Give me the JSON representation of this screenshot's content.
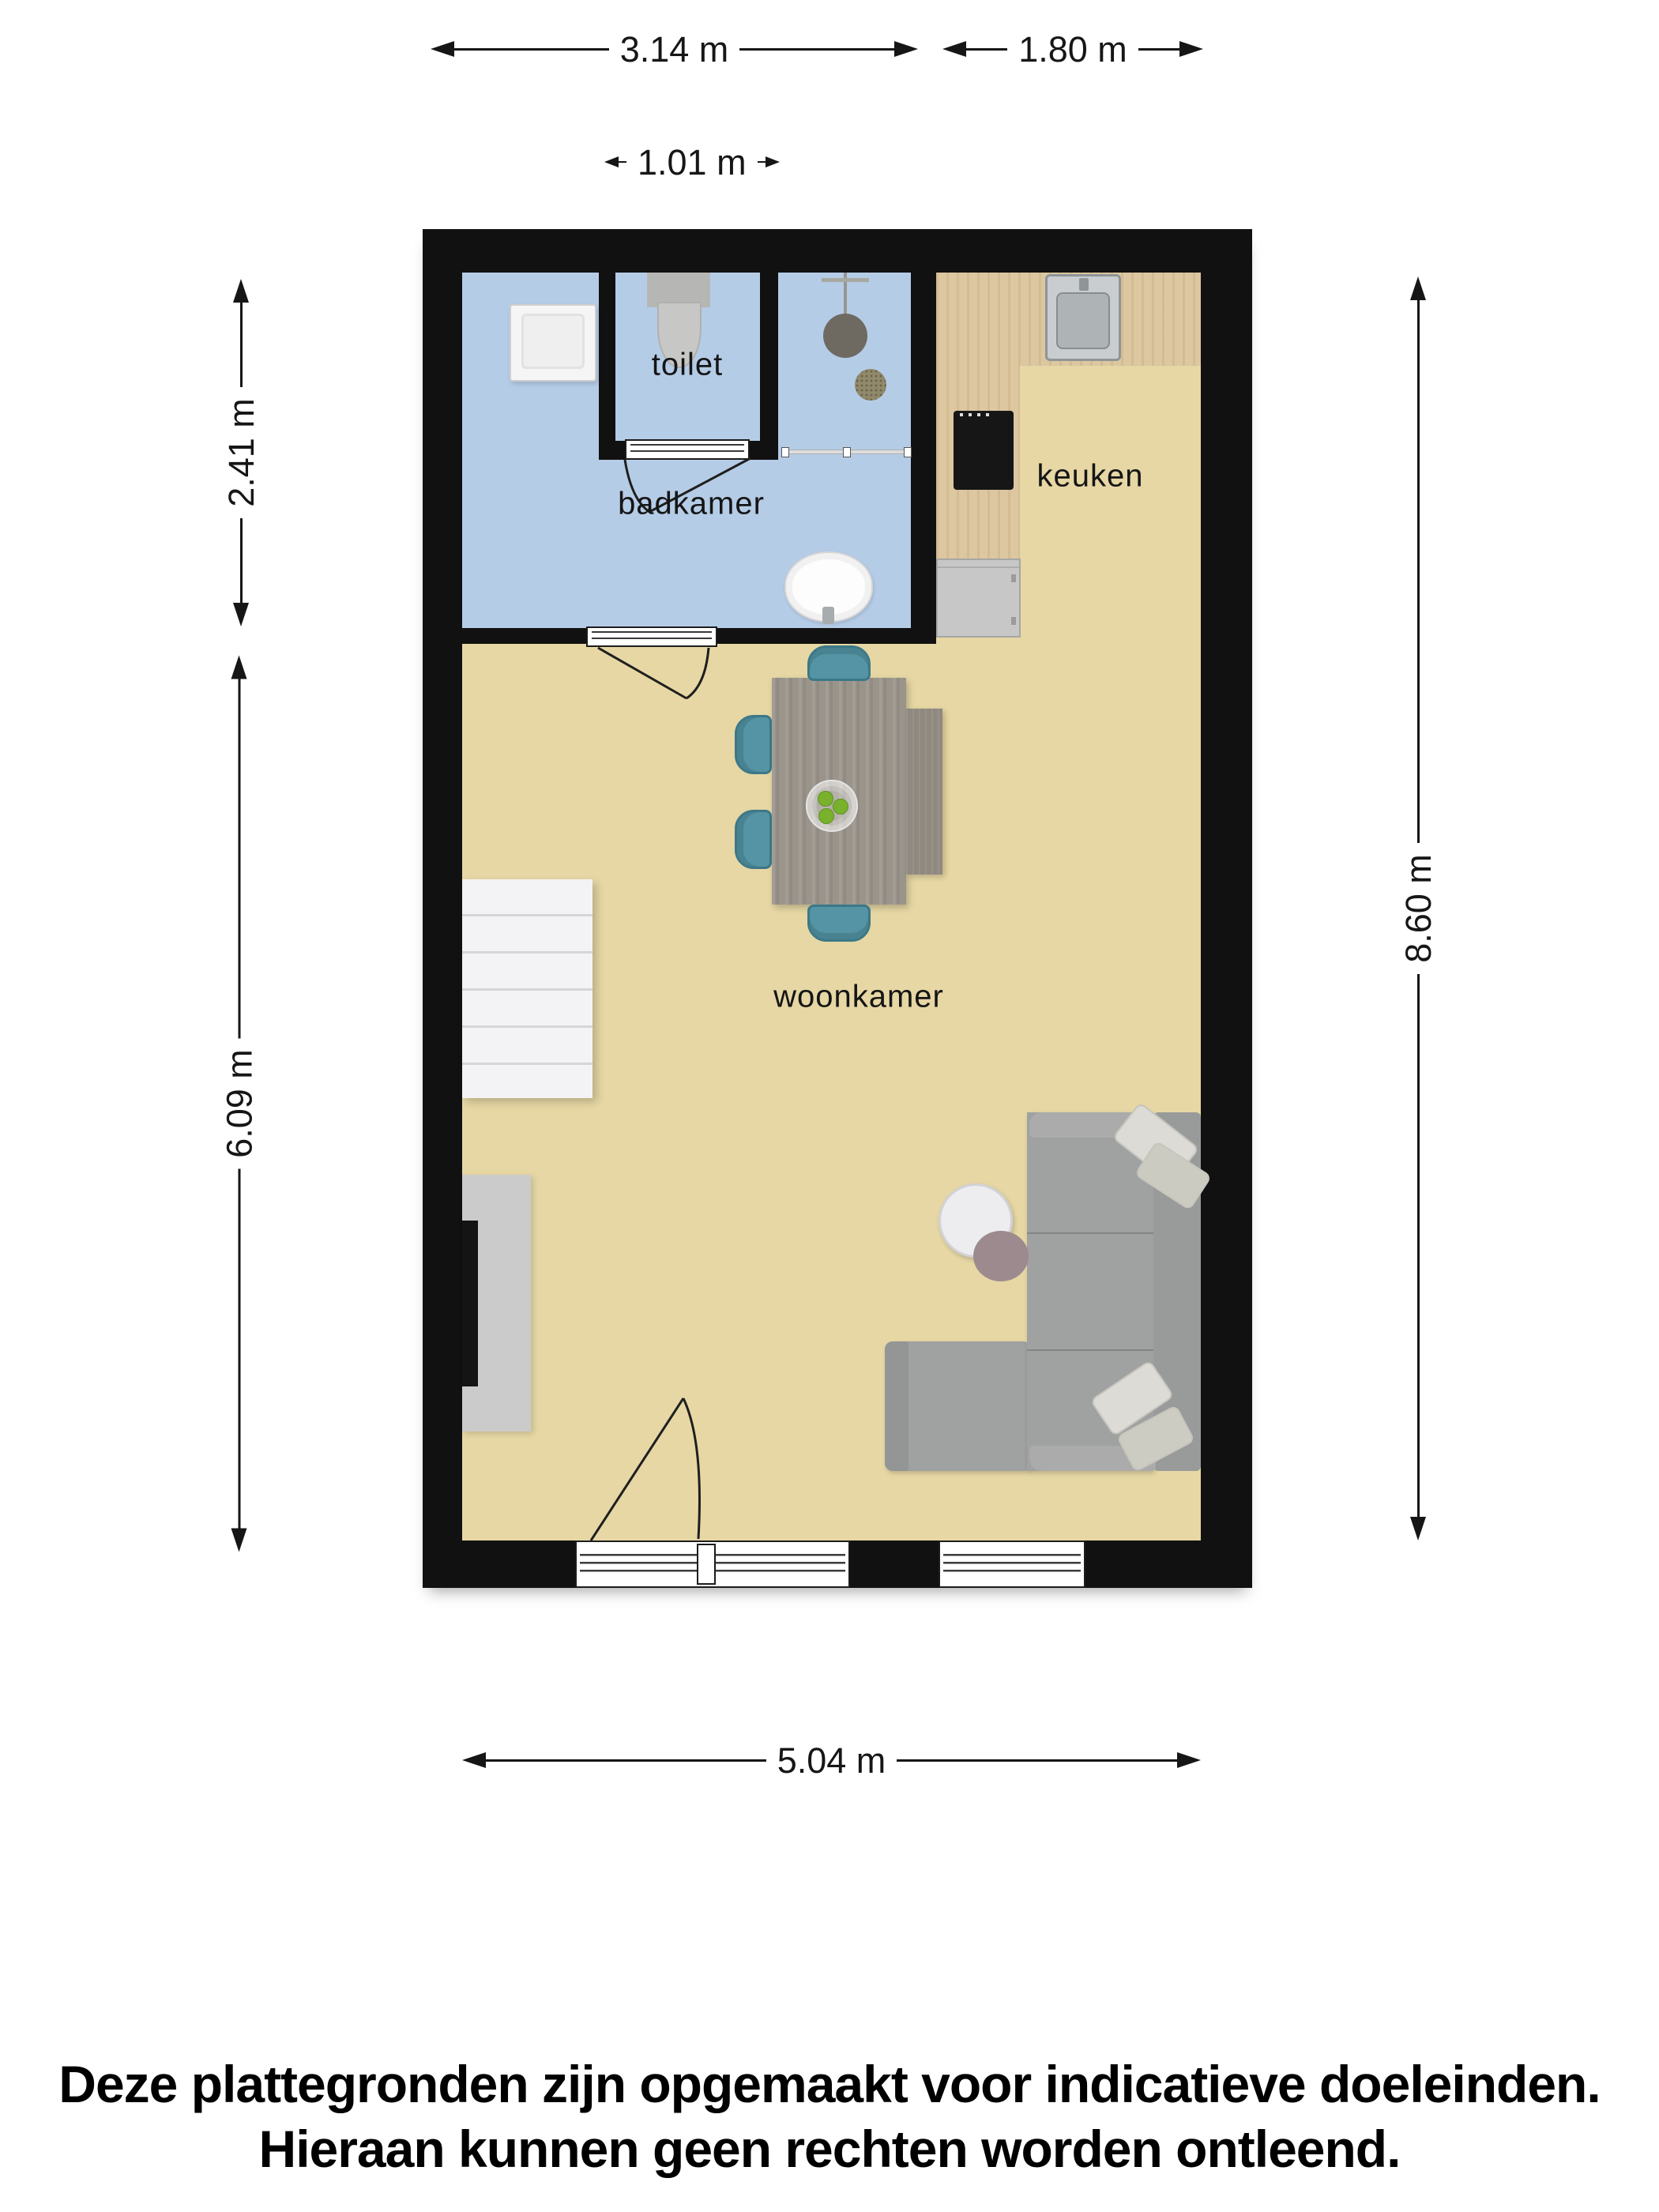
{
  "floor_plan": {
    "rooms": [
      {
        "id": "toilet",
        "label": "toilet"
      },
      {
        "id": "badkamer",
        "label": "badkamer"
      },
      {
        "id": "keuken",
        "label": "keuken"
      },
      {
        "id": "woonkamer",
        "label": "woonkamer"
      }
    ],
    "dimensions": {
      "badkamer_width": "3.14 m",
      "keuken_width": "1.80 m",
      "toilet_width": "1.01 m",
      "badkamer_depth": "2.41 m",
      "woonkamer_depth": "6.09 m",
      "total_depth": "8.60 m",
      "total_width": "5.04 m"
    },
    "fixtures": [
      "washing-machine",
      "toilet-fixture",
      "shower-head",
      "shower-drain",
      "shower-screen",
      "bathroom-sink",
      "kitchen-counter",
      "kitchen-sink",
      "cooktop",
      "dishwasher",
      "stairs",
      "tv-cabinet",
      "tv",
      "dining-table",
      "dining-bench",
      "dining-chairs",
      "fruit-bowl",
      "corner-sofa",
      "pillows",
      "coffee-tables",
      "entry-door",
      "window",
      "interior-doors"
    ]
  },
  "disclaimer": {
    "line1": "Deze plattegronden zijn opgemaakt voor indicatieve doeleinden.",
    "line2": "Hieraan kunnen geen rechten worden ontleend."
  },
  "colors": {
    "wall": "#111111",
    "bathroom-floor": "#b5cce7",
    "living-floor": "#e6d7a4",
    "counter-wood": "#dcc7a0",
    "chair-teal": "#5494a4",
    "sofa-gray": "#a0a1a1",
    "table-gray": "#9a948b",
    "ink": "#161616"
  }
}
